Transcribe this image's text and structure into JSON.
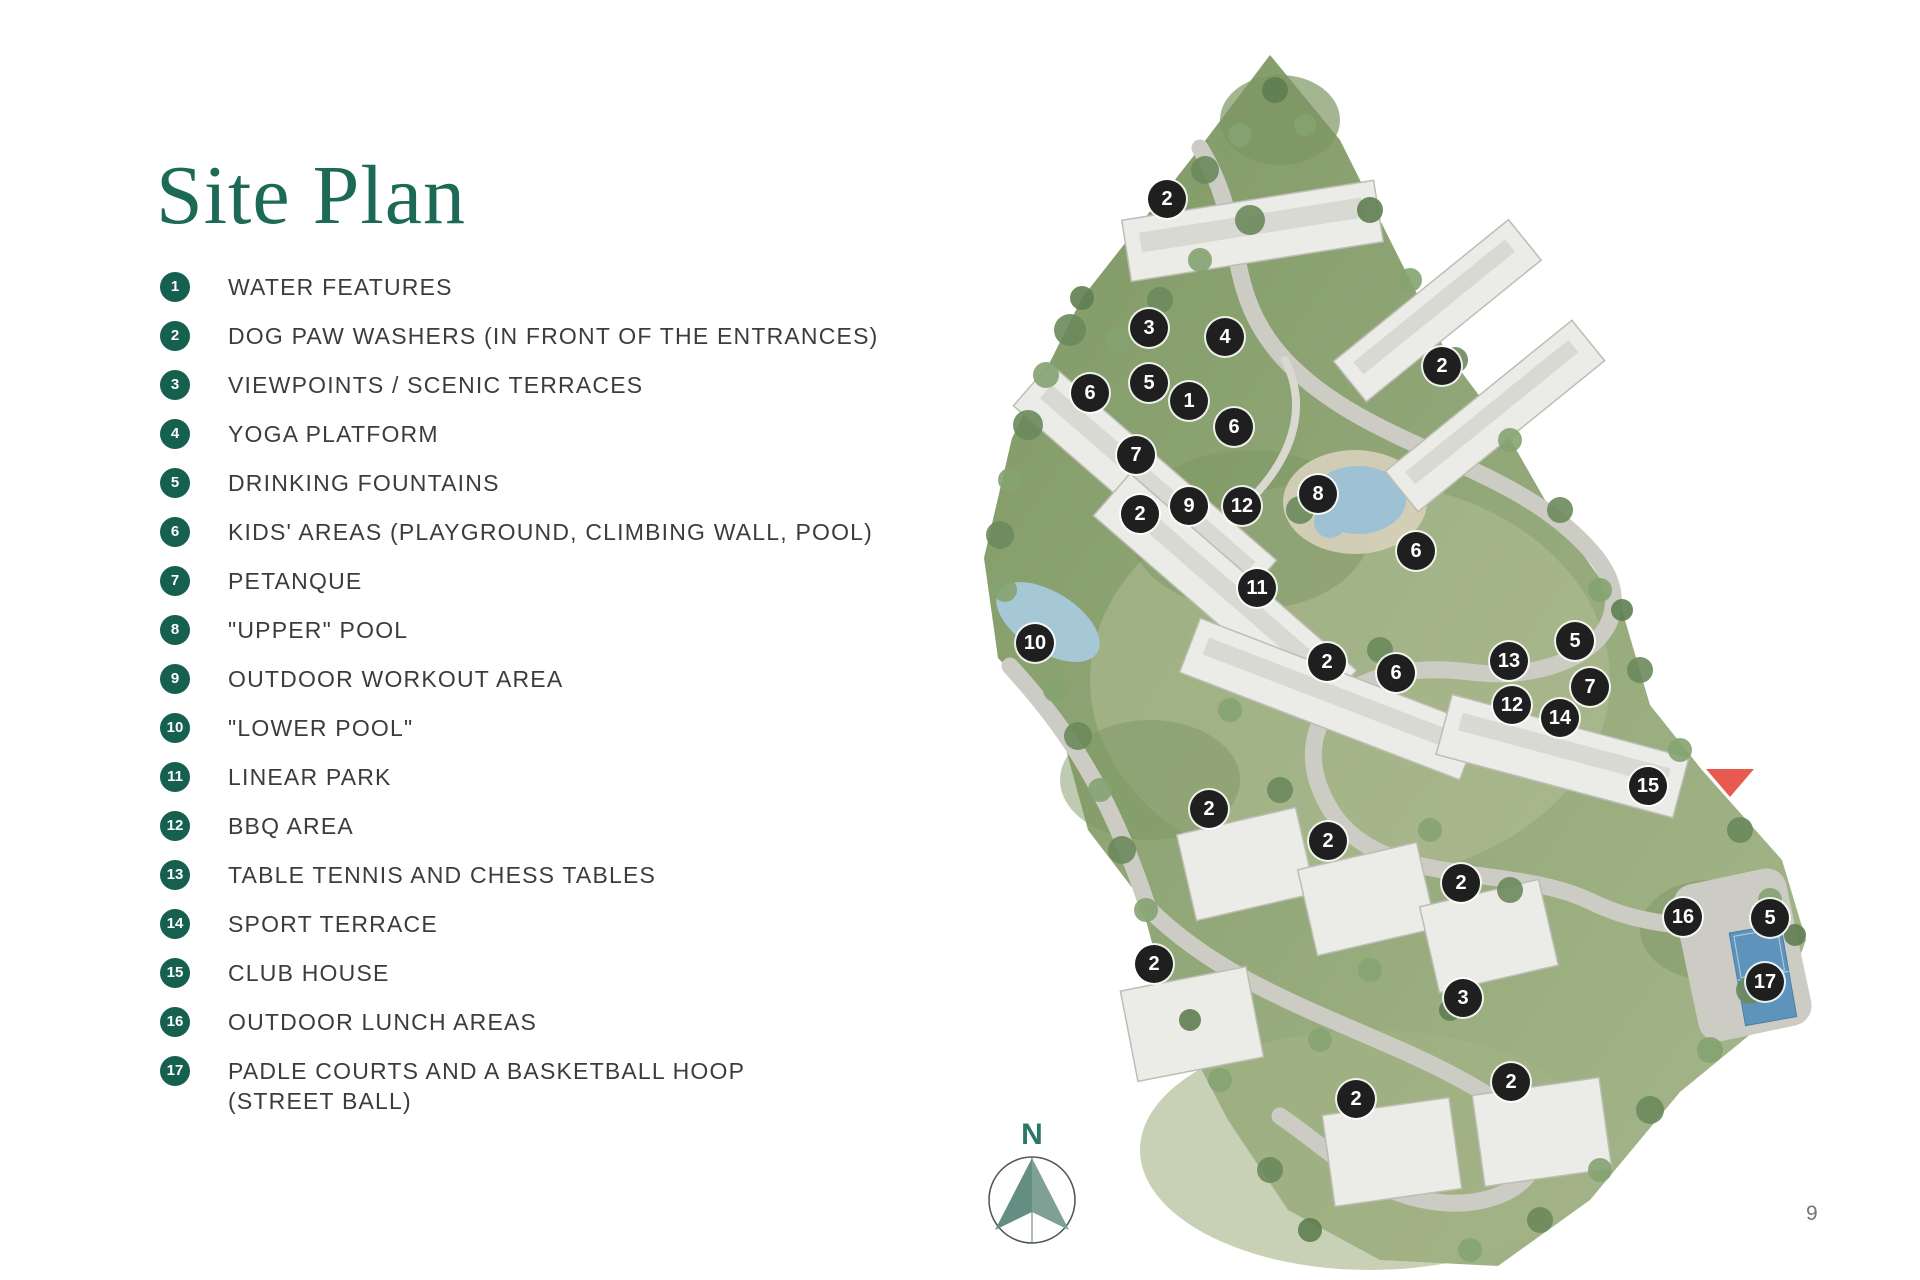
{
  "page": {
    "title": "Site Plan",
    "page_number": "9",
    "colors": {
      "title_green": "#1c6a55",
      "legend_badge_green": "#15604f",
      "marker_black": "#1f1f1f",
      "pin_red": "#e85a50",
      "compass_teal": "#2c7767"
    }
  },
  "legend": {
    "items": [
      {
        "number": "1",
        "label": "WATER FEATURES"
      },
      {
        "number": "2",
        "label": "DOG PAW WASHERS (IN FRONT OF THE ENTRANCES)"
      },
      {
        "number": "3",
        "label": "VIEWPOINTS / SCENIC TERRACES"
      },
      {
        "number": "4",
        "label": "YOGA PLATFORM"
      },
      {
        "number": "5",
        "label": "DRINKING FOUNTAINS"
      },
      {
        "number": "6",
        "label": "KIDS' AREAS (PLAYGROUND, CLIMBING WALL, POOL)"
      },
      {
        "number": "7",
        "label": "PETANQUE"
      },
      {
        "number": "8",
        "label": "\"UPPER\" POOL"
      },
      {
        "number": "9",
        "label": "OUTDOOR WORKOUT AREA"
      },
      {
        "number": "10",
        "label": "\"LOWER POOL\""
      },
      {
        "number": "11",
        "label": "LINEAR PARK"
      },
      {
        "number": "12",
        "label": "BBQ AREA"
      },
      {
        "number": "13",
        "label": "TABLE TENNIS AND CHESS TABLES"
      },
      {
        "number": "14",
        "label": "SPORT TERRACE"
      },
      {
        "number": "15",
        "label": "CLUB HOUSE"
      },
      {
        "number": "16",
        "label": "OUTDOOR LUNCH AREAS"
      },
      {
        "number": "17",
        "label": "PADLE COURTS AND A BASKETBALL HOOP",
        "label2": "(STREET BALL)"
      }
    ]
  },
  "map": {
    "compass_label": "N",
    "markers": [
      {
        "n": "2",
        "x": 1167,
        "y": 199
      },
      {
        "n": "3",
        "x": 1149,
        "y": 328
      },
      {
        "n": "4",
        "x": 1225,
        "y": 337
      },
      {
        "n": "5",
        "x": 1149,
        "y": 383
      },
      {
        "n": "6",
        "x": 1090,
        "y": 393
      },
      {
        "n": "1",
        "x": 1189,
        "y": 401
      },
      {
        "n": "6",
        "x": 1234,
        "y": 427
      },
      {
        "n": "2",
        "x": 1442,
        "y": 366
      },
      {
        "n": "7",
        "x": 1136,
        "y": 455
      },
      {
        "n": "8",
        "x": 1318,
        "y": 494
      },
      {
        "n": "9",
        "x": 1189,
        "y": 506
      },
      {
        "n": "12",
        "x": 1242,
        "y": 506
      },
      {
        "n": "2",
        "x": 1140,
        "y": 514
      },
      {
        "n": "6",
        "x": 1416,
        "y": 551
      },
      {
        "n": "11",
        "x": 1257,
        "y": 588
      },
      {
        "n": "10",
        "x": 1035,
        "y": 643
      },
      {
        "n": "2",
        "x": 1327,
        "y": 662
      },
      {
        "n": "6",
        "x": 1396,
        "y": 673
      },
      {
        "n": "13",
        "x": 1509,
        "y": 661
      },
      {
        "n": "5",
        "x": 1575,
        "y": 641
      },
      {
        "n": "7",
        "x": 1590,
        "y": 687
      },
      {
        "n": "12",
        "x": 1512,
        "y": 705
      },
      {
        "n": "14",
        "x": 1560,
        "y": 718
      },
      {
        "n": "15",
        "x": 1648,
        "y": 786
      },
      {
        "n": "2",
        "x": 1209,
        "y": 809
      },
      {
        "n": "2",
        "x": 1328,
        "y": 841
      },
      {
        "n": "2",
        "x": 1461,
        "y": 883
      },
      {
        "n": "16",
        "x": 1683,
        "y": 917
      },
      {
        "n": "5",
        "x": 1770,
        "y": 918
      },
      {
        "n": "2",
        "x": 1154,
        "y": 964
      },
      {
        "n": "3",
        "x": 1463,
        "y": 998
      },
      {
        "n": "17",
        "x": 1765,
        "y": 982
      },
      {
        "n": "2",
        "x": 1511,
        "y": 1082
      },
      {
        "n": "2",
        "x": 1356,
        "y": 1099
      }
    ],
    "location_pin": {
      "x": 1730,
      "y": 783,
      "color": "#e85a50"
    }
  }
}
